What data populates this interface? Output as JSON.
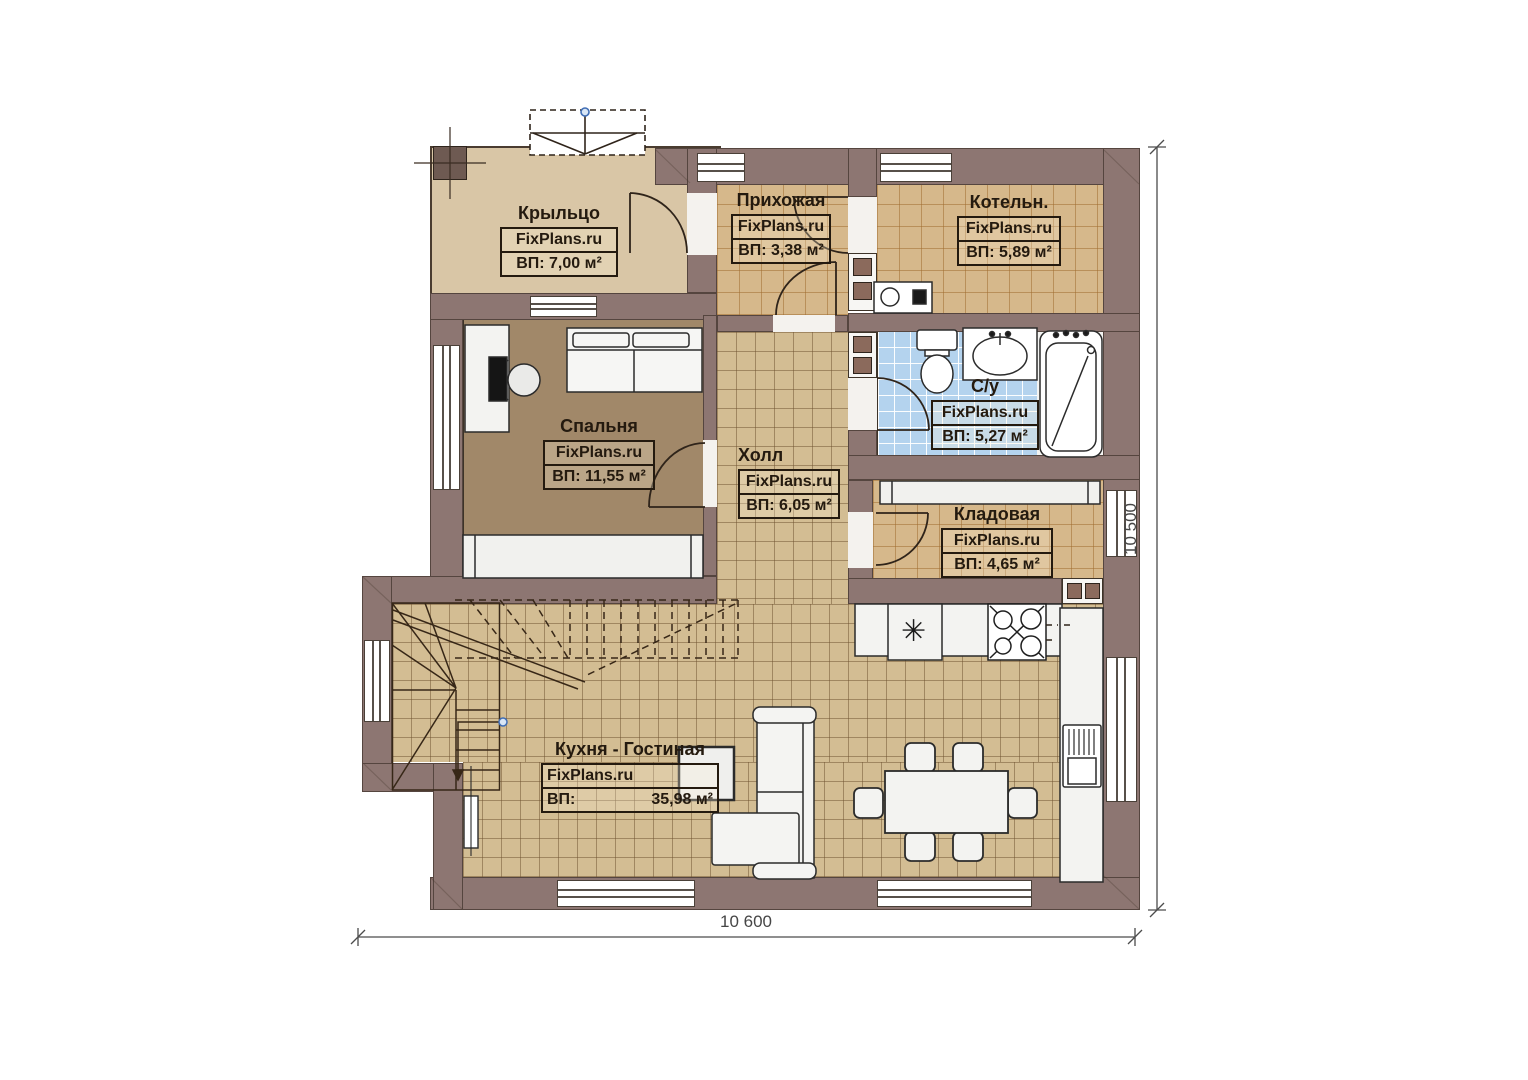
{
  "branding": {
    "site": "FixPlans.ru"
  },
  "rooms": [
    {
      "id": "porch",
      "name": "Крыльцо",
      "area_label": "ВП: 7,00 м²"
    },
    {
      "id": "hallway",
      "name": "Прихожая",
      "area_label": "ВП: 3,38 м²"
    },
    {
      "id": "boiler",
      "name": "Котельн.",
      "area_label": "ВП: 5,89 м²"
    },
    {
      "id": "bedroom",
      "name": "Спальня",
      "area_label": "ВП: 11,55 м²"
    },
    {
      "id": "hall",
      "name": "Холл",
      "area_label": "ВП: 6,05 м²"
    },
    {
      "id": "bathroom",
      "name": "С/у",
      "area_label": "ВП: 5,27 м²"
    },
    {
      "id": "storage",
      "name": "Кладовая",
      "area_label": "ВП: 4,65 м²"
    },
    {
      "id": "kitchen",
      "name": "Кухня - Гостиная",
      "area_prefix": "ВП:",
      "area_value": "35,98 м²"
    }
  ],
  "dimensions": {
    "bottom": "10 600",
    "right": "10 500"
  },
  "icons": {
    "sink_star": "✳"
  },
  "colors": {
    "wall": "#8d7672",
    "tile_warm": "#d6b88b",
    "tile_neutral": "#d3bd93",
    "tile_blue": "#b4d3ee",
    "bedroom_floor": "#a18869",
    "porch_floor": "#d9c6a6",
    "marker_blue": "#3f6db5",
    "label_ink": "#241a0f"
  }
}
